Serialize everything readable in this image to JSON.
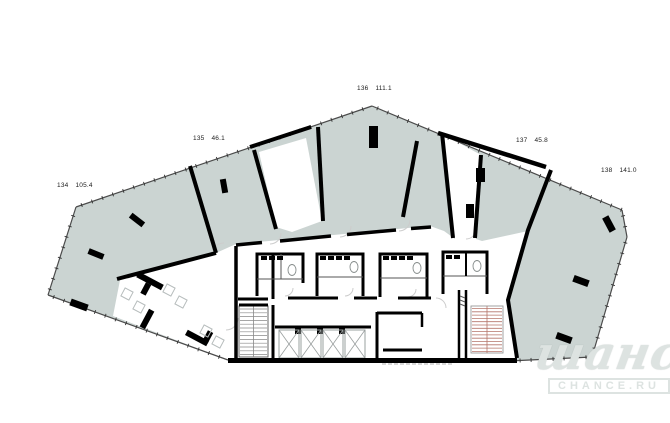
{
  "floor_plan": {
    "units": [
      {
        "number": "134",
        "area": "105.4"
      },
      {
        "number": "135",
        "area": "46.1"
      },
      {
        "number": "136",
        "area": "111.1"
      },
      {
        "number": "137",
        "area": "45.8"
      },
      {
        "number": "138",
        "area": "141.0"
      }
    ]
  },
  "watermark": {
    "title": "шанс",
    "subtitle": "CHANCE.RU"
  },
  "colors": {
    "unit_fill": "#cbd4d2",
    "wall": "#000000",
    "door_arc": "#cccccc",
    "stair_treads": "#b5756a",
    "watermark": "#dde3e1"
  }
}
